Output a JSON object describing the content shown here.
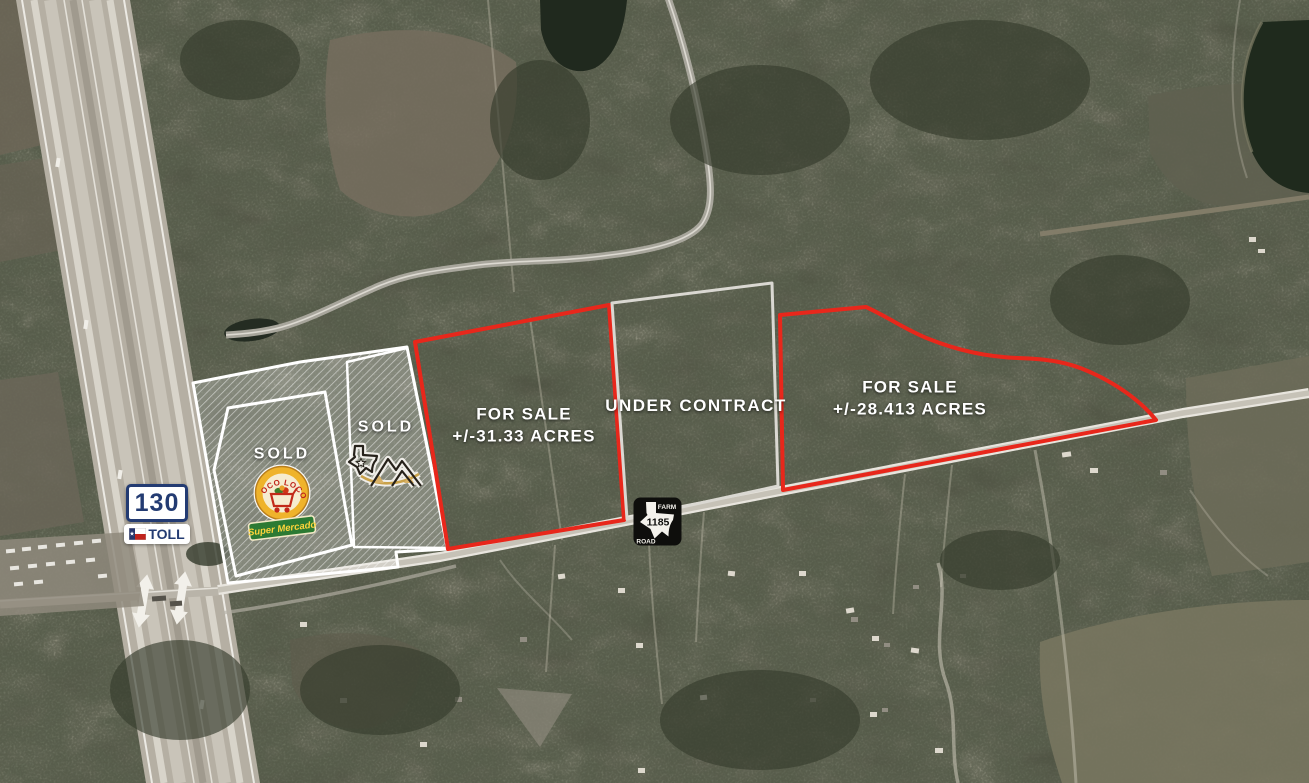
{
  "map": {
    "parcels": [
      {
        "id": "sold-poco-loco",
        "status_label": "SOLD"
      },
      {
        "id": "sold-star",
        "status_label": "SOLD"
      },
      {
        "id": "for-sale-31",
        "line1": "FOR SALE",
        "line2": "+/-31.33 ACRES"
      },
      {
        "id": "under-contract",
        "line1": "UNDER CONTRACT",
        "line2": ""
      },
      {
        "id": "for-sale-28",
        "line1": "FOR SALE",
        "line2": "+/-28.413 ACRES"
      }
    ],
    "highway_shield": {
      "route_number": "130",
      "toll_label": "TOLL"
    },
    "farm_road_shield": {
      "top_label": "FARM",
      "bottom_label": "ROAD",
      "route_number": "1185"
    },
    "poco_loco_logo": {
      "arc_text": "POCO LOCO",
      "banner_text": "Super Mercado"
    },
    "colors": {
      "for_sale_outline": "#e8271b",
      "under_contract_outline": "#dad8d2",
      "sold_outline": "#ffffff",
      "label_text": "#ffffff",
      "shield_navy": "#233b72",
      "shield_black": "#0e0e0c",
      "logo_gold": "#efb32b",
      "banner_green": "#2c7a33"
    }
  }
}
